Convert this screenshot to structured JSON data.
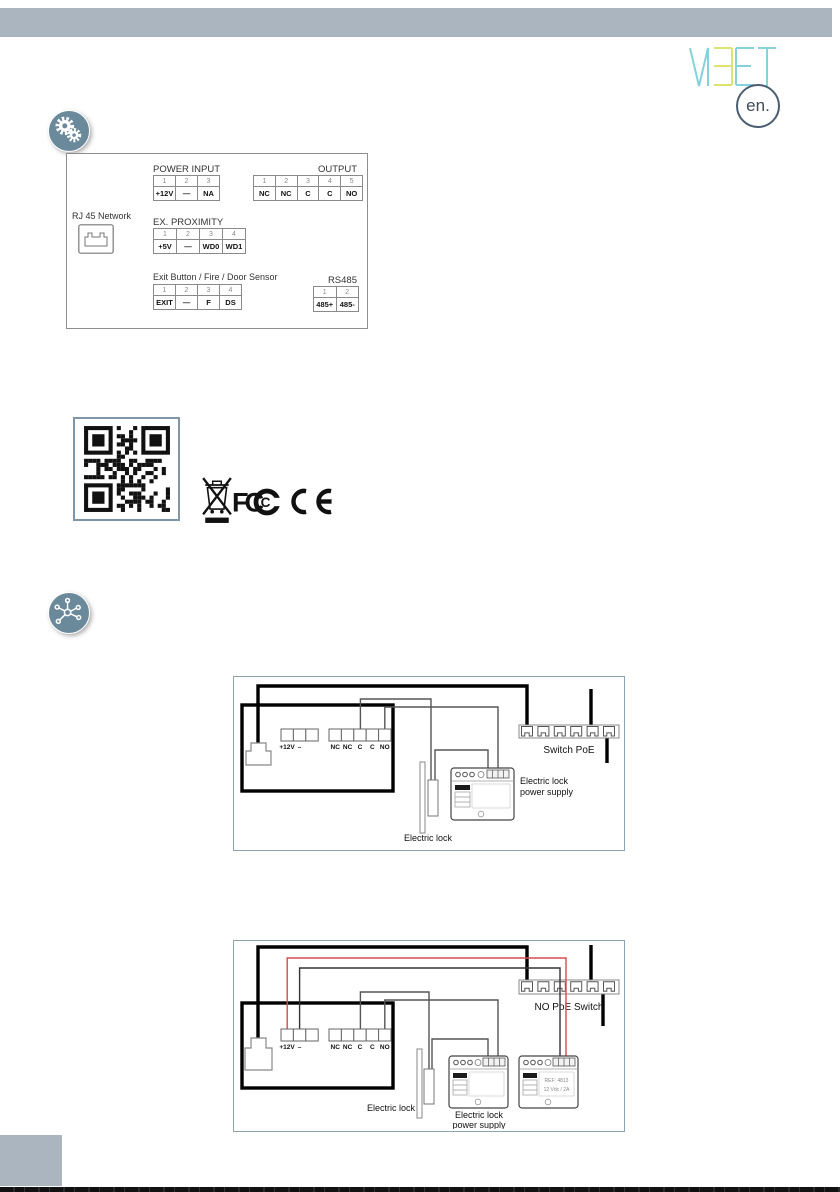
{
  "header": {
    "logo_text": "MEET",
    "lang_badge": "en."
  },
  "connector_panel": {
    "power_input": {
      "title": "POWER INPUT",
      "pins": [
        "1",
        "2",
        "3"
      ],
      "labels": [
        "+12V",
        "—",
        "NA"
      ]
    },
    "output": {
      "title": "OUTPUT",
      "pins": [
        "1",
        "2",
        "3",
        "4",
        "5"
      ],
      "labels": [
        "NC",
        "NC",
        "C",
        "C",
        "NO"
      ]
    },
    "rj45_label": "RJ 45 Network",
    "ex_proximity": {
      "title": "EX. PROXIMITY",
      "pins": [
        "1",
        "2",
        "3",
        "4"
      ],
      "labels": [
        "+5V",
        "—",
        "WD0",
        "WD1"
      ]
    },
    "exit_fire_door": {
      "title": "Exit Button / Fire / Door Sensor",
      "pins": [
        "1",
        "2",
        "3",
        "4"
      ],
      "labels": [
        "EXIT",
        "—",
        "F",
        "DS"
      ]
    },
    "rs485": {
      "title": "RS485",
      "pins": [
        "1",
        "2"
      ],
      "labels": [
        "485+",
        "485-"
      ]
    }
  },
  "certifications": {
    "marks": [
      "WEEE",
      "FCC",
      "CE"
    ]
  },
  "diagram_poe": {
    "terminal_power": [
      "+12V",
      "–"
    ],
    "terminal_relay": [
      "NC",
      "NC",
      "C",
      "C",
      "NO"
    ],
    "switch_label": "Switch PoE",
    "electric_lock_label": "Electric lock",
    "psu_label_line1": "Electric lock",
    "psu_label_line2": "power supply"
  },
  "diagram_no_poe": {
    "terminal_power": [
      "+12V",
      "–"
    ],
    "terminal_relay": [
      "NC",
      "NC",
      "C",
      "C",
      "NO"
    ],
    "switch_label": "NO PoE Switch",
    "electric_lock_label": "Electric lock",
    "psu_label_line1": "Electric lock",
    "psu_label_line2": "power supply",
    "psu2_ref": "REF: 4813",
    "psu2_spec": "12 Vdc / 2A"
  },
  "colors": {
    "top_bar": "#abb5bf",
    "icon_circle": "#6a8a9b",
    "logo_cyan": "#85d2dc",
    "logo_yellow": "#dfe26e",
    "wire_red": "#d84b4b",
    "diagram_border": "#8ba3b3"
  }
}
